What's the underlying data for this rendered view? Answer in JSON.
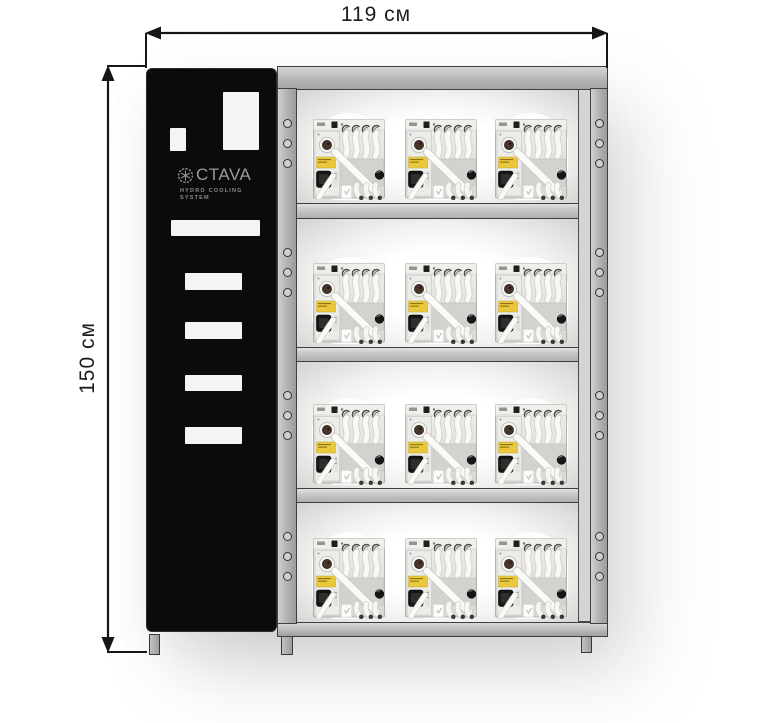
{
  "diagram": {
    "width_dimension": "119 см",
    "height_dimension": "150 см"
  },
  "branding": {
    "logo_icon": "snowflake-gear-icon",
    "logo_text": "CTAVA",
    "tagline_line1": "HYDRO COOLING",
    "tagline_line2": "SYSTEM"
  },
  "cabinet": {
    "shelf_rows": 4,
    "units_per_shelf": 3,
    "total_units": 12,
    "hole_levels": 4,
    "mounting_holes_per_level": 3
  },
  "colors": {
    "panel_black": "#0b0b0b",
    "frame_gray": "#b5b5b3",
    "frame_border": "#3f3f3f",
    "logo_gray": "#9a9a9a",
    "unit_label_yellow": "#eac83e",
    "dimension_line": "#161616",
    "background": "#ffffff"
  }
}
